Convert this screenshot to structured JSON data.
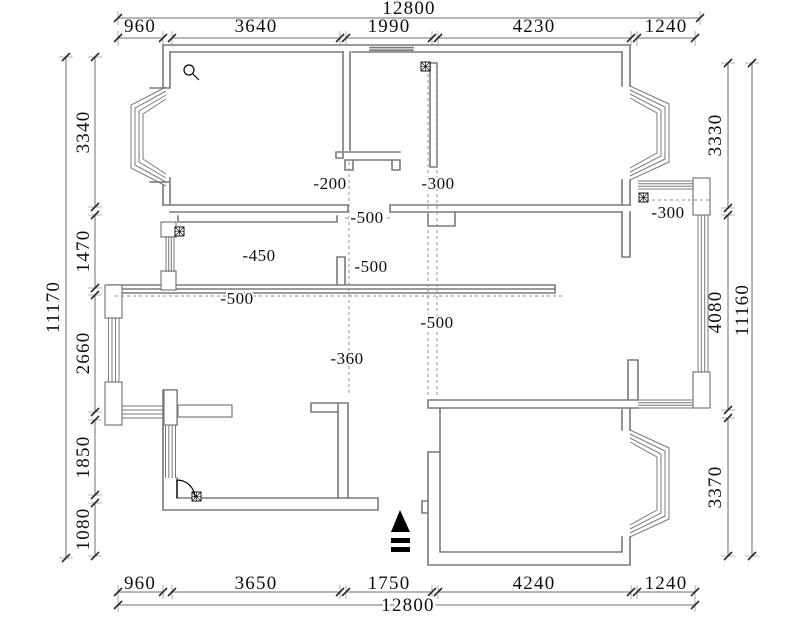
{
  "page": {
    "title": "Apartment floor plan with level offsets"
  },
  "colors": {
    "background": "#ffffff",
    "wall": "#7a7a7a",
    "dim_line": "#6f6f6f",
    "dashed": "#909090",
    "text": "#0f0f0f",
    "symbol": "#000000"
  },
  "dimensions": {
    "top": {
      "total": "12800",
      "segments": [
        "960",
        "3640",
        "1990",
        "4230",
        "1240"
      ]
    },
    "bottom": {
      "total": "12800",
      "segments": [
        "960",
        "3650",
        "1750",
        "4240",
        "1240"
      ]
    },
    "left": {
      "total": "11170",
      "segments": [
        "3340",
        "1470",
        "2660",
        "1850",
        "1080"
      ]
    },
    "right": {
      "total": "11160",
      "segments": [
        "3330",
        "4080",
        "3370"
      ]
    }
  },
  "annotations": {
    "levels": [
      "-200",
      "-300",
      "-500",
      "-500",
      "-450",
      "-500",
      "-300",
      "-360",
      "-500"
    ]
  },
  "symbols": {
    "entrance_arrow": "entrance-arrow",
    "floor_drain": "floor-drain",
    "magnifier": "magnifier-mark",
    "door_swing": "door-swing"
  }
}
